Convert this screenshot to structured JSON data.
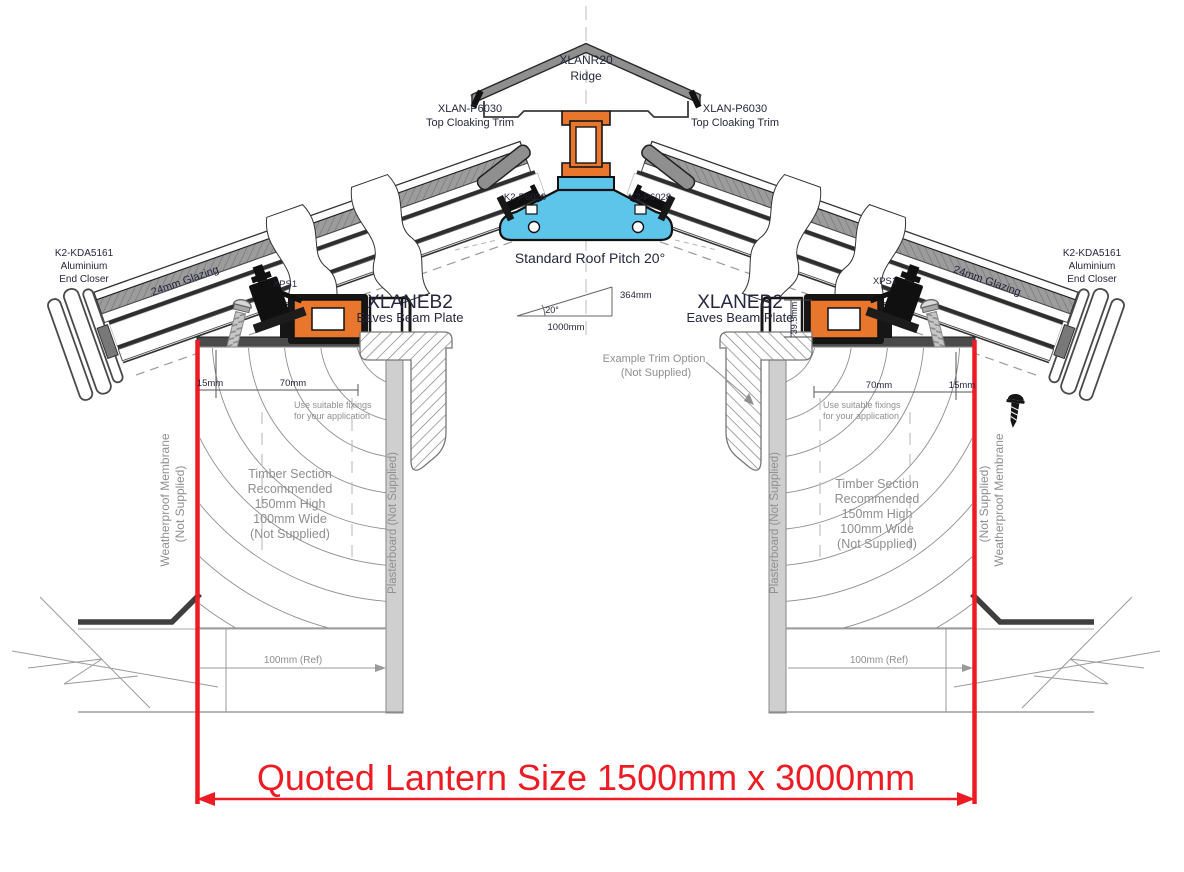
{
  "drawing": {
    "type": "roof-lantern-cross-section",
    "pitch_degrees": 20,
    "colors": {
      "accent_red": "#ed1c24",
      "profile_orange": "#e8762c",
      "thermal_blue": "#5ec5ea",
      "metal_dark": "#2e2e2e",
      "hatch_gray": "#9c9c9c",
      "text_dark": "#26263e",
      "text_gray": "#8f8f8f"
    }
  },
  "labels": {
    "ridge_code": "XLANR20",
    "ridge_name": "Ridge",
    "cloaking_code": "XLAN-P6030",
    "cloaking_name": "Top Cloaking Trim",
    "ridge_beam_code": "K2-P6028",
    "pitch_note": "Standard Roof Pitch 20°",
    "pitch_angle": "20°",
    "pitch_run": "1000mm",
    "pitch_rise": "364mm",
    "end_closer": [
      "K2-KDA5161",
      "Aluminium",
      "End Closer"
    ],
    "glazing": "24mm Glazing",
    "xps": "XPS1",
    "eaves_code": "XLANEB2",
    "eaves_name": "Eaves Beam Plate",
    "dim_15": "15mm",
    "dim_70": "70mm",
    "dim_39_5": "39.5mm",
    "fixings": [
      "Use suitable fixings",
      "for your application"
    ],
    "timber": [
      "Timber Section",
      "Recommended",
      "150mm High",
      "100mm Wide",
      "(Not Supplied)"
    ],
    "membrane_line1": "Weatherproof Membrane",
    "membrane_line2": "(Not Supplied)",
    "plasterboard": "Plasterboard (Not Supplied)",
    "trim_option_line1": "Example Trim Option",
    "trim_option_line2": "(Not Supplied)",
    "ref_dim": "100mm (Ref)",
    "quoted_size": "Quoted Lantern Size 1500mm x 3000mm"
  }
}
